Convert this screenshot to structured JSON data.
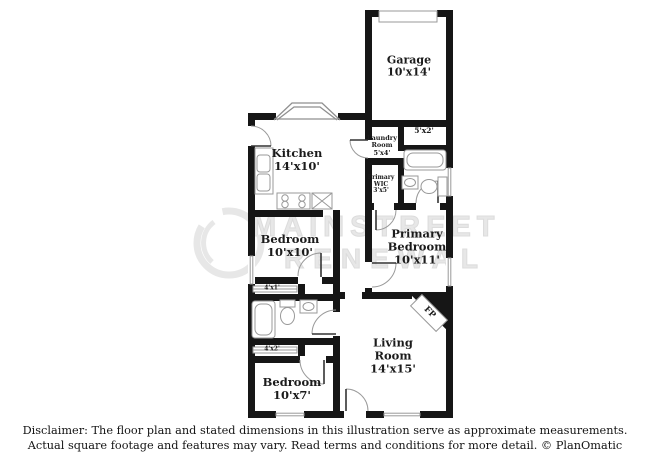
{
  "colors": {
    "wall": "#161616",
    "thin_line": "#8f8f8f",
    "label_text": "#1b1b1b",
    "watermark": "#e7e7e7"
  },
  "rooms": {
    "garage": {
      "name": "Garage",
      "dims": "10'x14'"
    },
    "nook": {
      "dims": "5'x2'"
    },
    "laundry": {
      "name": "Laundry Room",
      "dims": "5'x4'"
    },
    "primary_wic": {
      "name": "Primary WIC",
      "dims": "3'x5'"
    },
    "kitchen": {
      "name": "Kitchen",
      "dims": "14'x10'"
    },
    "bedroom_2": {
      "name": "Bedroom",
      "dims": "10'x10'"
    },
    "primary_bedroom": {
      "name": "Primary Bedroom",
      "dims": "10'x11'"
    },
    "living_room": {
      "name": "Living Room",
      "dims": "14'x15'"
    },
    "bedroom_3": {
      "name": "Bedroom",
      "dims": "10'x7'"
    },
    "closet_hall_1": {
      "dims": "4'x1'"
    },
    "closet_hall_2": {
      "dims": "4'x2'"
    },
    "fireplace": {
      "label": "FP"
    }
  },
  "watermark": {
    "line1": "MAINSTREET",
    "line2": "RENEWAL"
  },
  "disclaimer": {
    "line1": "Disclaimer: The floor plan and stated dimensions in this illustration serve as approximate measurements.",
    "line2": "Actual square footage and features may vary. Read terms and conditions for more detail. © PlanOmatic"
  }
}
